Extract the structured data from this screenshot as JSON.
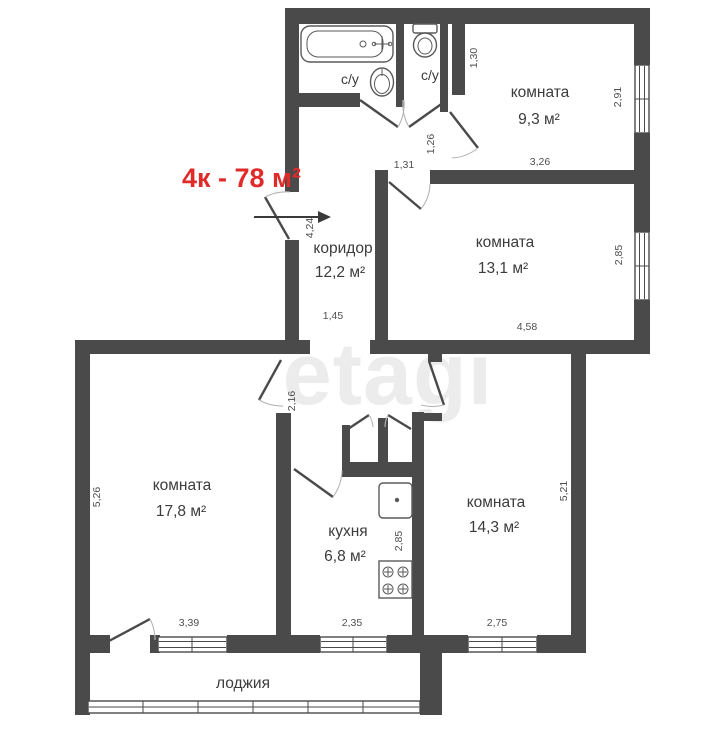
{
  "title": "4к - 78 м²",
  "watermark": "etagi",
  "colors": {
    "wall": "#4a4a4a",
    "accent": "#e02b2b",
    "text": "#3c3c3c",
    "dim": "#4f4f4f",
    "watermark": "#ececec",
    "arc": "#b5b5b5"
  },
  "rooms": {
    "bathroom": {
      "label": "с/у"
    },
    "wc": {
      "label": "с/у"
    },
    "room_top": {
      "name": "комната",
      "area": "9,3 м²"
    },
    "room_right": {
      "name": "комната",
      "area": "13,1 м²"
    },
    "corridor": {
      "name": "коридор",
      "area": "12,2 м²"
    },
    "room_left": {
      "name": "комната",
      "area": "17,8 м²"
    },
    "kitchen": {
      "name": "кухня",
      "area": "6,8 м²"
    },
    "room_bottom": {
      "name": "комната",
      "area": "14,3 м²"
    },
    "loggia": {
      "name": "лоджия"
    }
  },
  "dims": {
    "niche_h": "1,30",
    "room_top_h": "2,91",
    "room_top_w": "3,26",
    "nook_h": "1,26",
    "nook_w": "1,31",
    "corridor_h": "4,24",
    "corridor_w": "1,45",
    "room_right_h": "2,85",
    "room_right_w": "4,58",
    "hall_h": "2,16",
    "room_left_h": "5,26",
    "room_left_w": "3,39",
    "kitchen_h": "2,85",
    "kitchen_w": "2,35",
    "room_bottom_h": "5,21",
    "room_bottom_w": "2,75"
  }
}
